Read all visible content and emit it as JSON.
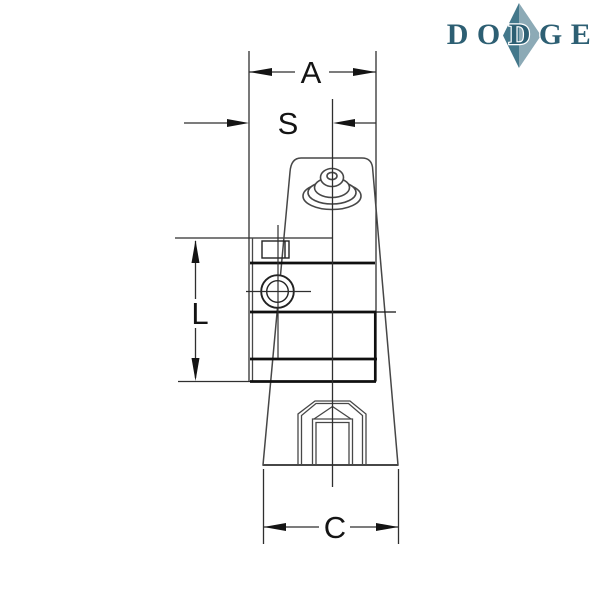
{
  "brand": {
    "name": "DODGE",
    "diamond_left_color": "#44788b",
    "diamond_right_color": "#8caab6",
    "text_color": "#2d5f73"
  },
  "drawing": {
    "labels": {
      "overall_width": "A",
      "face_to_center": "S",
      "bolt_spacing_height": "L",
      "base_width": "C"
    },
    "colors": {
      "thin_line": "#2f2f2f",
      "thick_line": "#101010",
      "edge_line": "#474747",
      "label_color": "#141414"
    }
  }
}
